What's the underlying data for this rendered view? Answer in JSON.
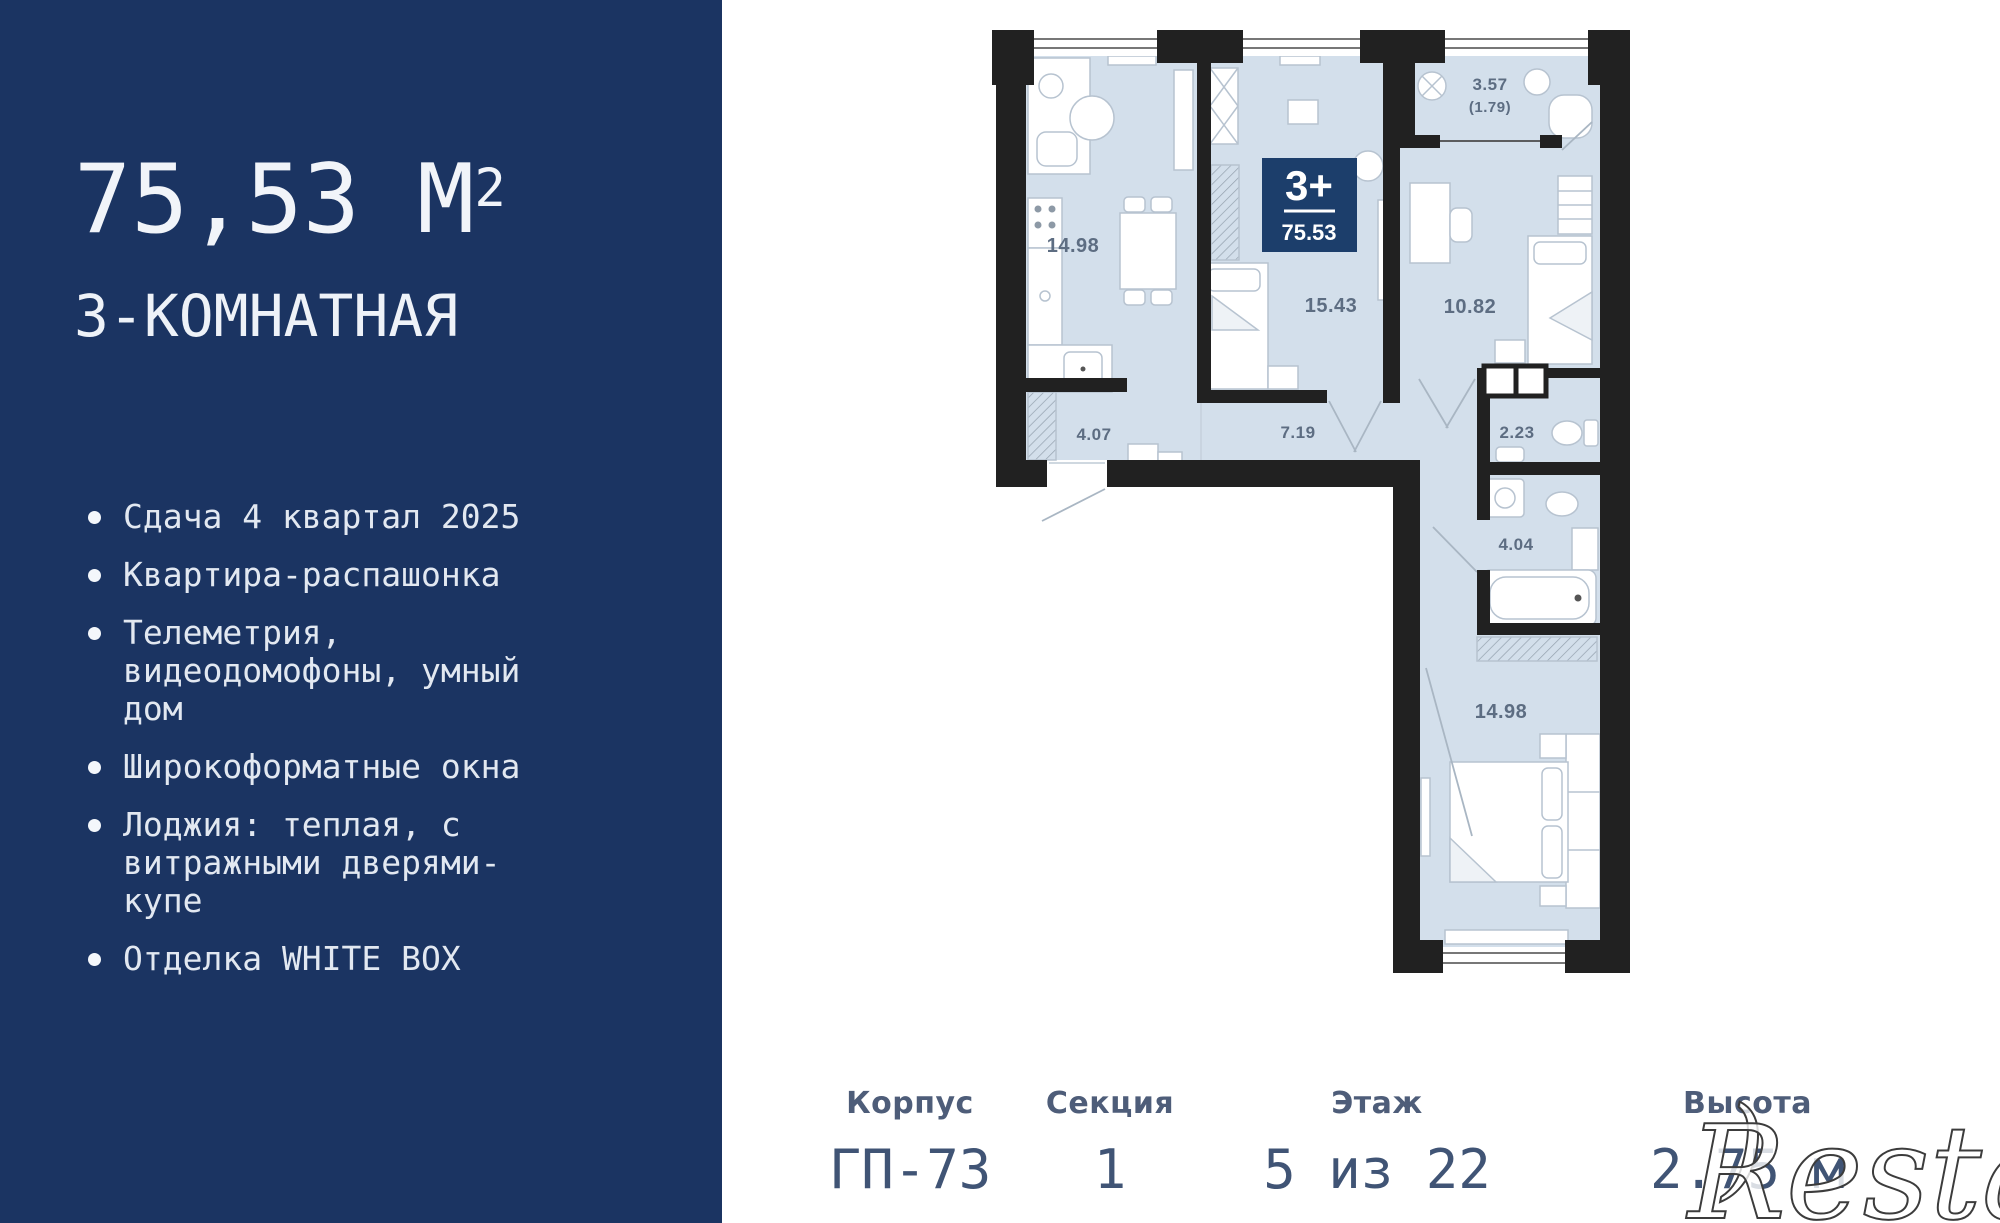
{
  "sidebar": {
    "area": "75,53 М",
    "area_sup": "2",
    "type": "3-КОМНАТНАЯ",
    "features": [
      "Сдача 4 квартал 2025",
      "Квартира-распашонка",
      "Телеметрия, видеодомофоны, умный дом",
      "Широкоформатные окна",
      "Лоджия: теплая, с витражными дверями-купе",
      "Отделка WHITE BOX"
    ],
    "bg_color": "#1b3462"
  },
  "plan": {
    "badge": {
      "rooms": "3+",
      "area": "75.53",
      "bg_color": "#1c3e6b"
    },
    "labels": {
      "kitchen_living": "14.98",
      "bedroom": "15.43",
      "children_room": "10.82",
      "loggia": "3.57",
      "loggia_reduced": "(1.79)",
      "hallway": "4.07",
      "corridor": "7.19",
      "wc": "2.23",
      "bathroom": "4.04",
      "bedroom2": "14.98"
    },
    "colors": {
      "wall": "#212121",
      "room_fill": "#d3dfeb",
      "label": "#5d6d82"
    }
  },
  "info": {
    "items": [
      {
        "label": "Корпус",
        "value": "ГП-73"
      },
      {
        "label": "Секция",
        "value": "1"
      },
      {
        "label": "Этаж",
        "value": "5 из 22"
      },
      {
        "label": "Высота",
        "value": "2.75 м"
      }
    ]
  },
  "watermark": {
    "paren": ")",
    "text": "Restate"
  }
}
